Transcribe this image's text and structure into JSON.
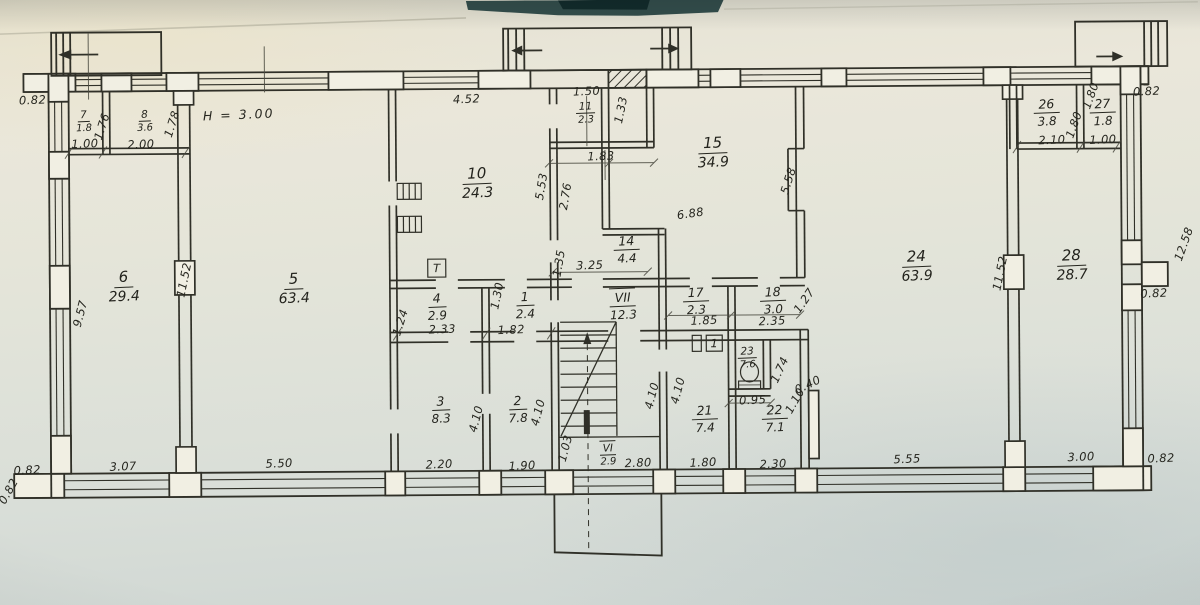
{
  "document": {
    "type": "scanned floor plan (BTI technical passport style)",
    "colors": {
      "paper": "#e6e4d7",
      "ink": "#2f2f28",
      "photo_edge": "#2a4644"
    }
  },
  "plan": {
    "height_note": "H = 3.00",
    "rooms": [
      {
        "no": "7",
        "area": "1.8",
        "x": 85,
        "y": 116,
        "s": "sm"
      },
      {
        "no": "8",
        "area": "3.6",
        "x": 146,
        "y": 116,
        "s": "sm"
      },
      {
        "no": "6",
        "area": "29.4",
        "x": 124,
        "y": 283,
        "s": "lg"
      },
      {
        "no": "5",
        "area": "63.4",
        "x": 294,
        "y": 286,
        "s": "lg"
      },
      {
        "no": "10",
        "area": "24.3",
        "x": 478,
        "y": 182,
        "s": "lg"
      },
      {
        "no": "11",
        "area": "2.3",
        "x": 587,
        "y": 111,
        "s": "sm"
      },
      {
        "no": "15",
        "area": "34.9",
        "x": 714,
        "y": 153,
        "s": "lg"
      },
      {
        "no": "14",
        "area": "4.4",
        "x": 627,
        "y": 249,
        "s": "md"
      },
      {
        "no": "VII",
        "area": "12.3",
        "x": 623,
        "y": 305,
        "s": "md",
        "rm": true
      },
      {
        "no": "17",
        "area": "2.3",
        "x": 696,
        "y": 301,
        "s": "md"
      },
      {
        "no": "18",
        "area": "3.0",
        "x": 773,
        "y": 301,
        "s": "md"
      },
      {
        "no": "4",
        "area": "2.9",
        "x": 437,
        "y": 305,
        "s": "md"
      },
      {
        "no": "1",
        "area": "2.4",
        "x": 525,
        "y": 304,
        "s": "md"
      },
      {
        "no": "3",
        "area": "8.3",
        "x": 440,
        "y": 408,
        "s": "md"
      },
      {
        "no": "2",
        "area": "7.8",
        "x": 517,
        "y": 408,
        "s": "md"
      },
      {
        "no": "VI",
        "area": "2.9",
        "x": 607,
        "y": 453,
        "s": "sm",
        "rm": true
      },
      {
        "no": "21",
        "area": "7.4",
        "x": 704,
        "y": 419,
        "s": "md"
      },
      {
        "no": "22",
        "area": "7.1",
        "x": 774,
        "y": 419,
        "s": "md"
      },
      {
        "no": "23",
        "area": "7.6",
        "x": 747,
        "y": 357,
        "s": "sm"
      },
      {
        "no": "24",
        "area": "63.9",
        "x": 917,
        "y": 268,
        "s": "lg"
      },
      {
        "no": "28",
        "area": "28.7",
        "x": 1072,
        "y": 268,
        "s": "lg"
      },
      {
        "no": "26",
        "area": "3.8",
        "x": 1048,
        "y": 115,
        "s": "md"
      },
      {
        "no": "27",
        "area": "1.8",
        "x": 1104,
        "y": 115,
        "s": "md"
      }
    ],
    "dims": [
      {
        "t": "0.82",
        "x": 34,
        "y": 96
      },
      {
        "t": "1.00",
        "x": 86,
        "y": 140
      },
      {
        "t": "2.00",
        "x": 142,
        "y": 141
      },
      {
        "t": "1.76",
        "x": 103,
        "y": 123,
        "r": -72
      },
      {
        "t": "1.78",
        "x": 173,
        "y": 121,
        "r": -72
      },
      {
        "t": "H = 3.00",
        "x": 240,
        "y": 112,
        "c": "note"
      },
      {
        "t": "4.52",
        "x": 468,
        "y": 98
      },
      {
        "t": "1.50",
        "x": 588,
        "y": 91
      },
      {
        "t": "1.33",
        "x": 622,
        "y": 110,
        "r": -78
      },
      {
        "t": "1.83",
        "x": 602,
        "y": 156
      },
      {
        "t": "5.53",
        "x": 542,
        "y": 186,
        "r": -80
      },
      {
        "t": "2.76",
        "x": 566,
        "y": 196,
        "r": -80
      },
      {
        "t": "6.88",
        "x": 691,
        "y": 214,
        "r": -8
      },
      {
        "t": "5.58",
        "x": 789,
        "y": 182,
        "r": -72
      },
      {
        "t": "0.82",
        "x": 1148,
        "y": 95
      },
      {
        "t": "1.80",
        "x": 1092,
        "y": 99,
        "r": -70
      },
      {
        "t": "1.80",
        "x": 1075,
        "y": 128,
        "r": -70
      },
      {
        "t": "2.10",
        "x": 1053,
        "y": 143
      },
      {
        "t": "1.00",
        "x": 1104,
        "y": 143
      },
      {
        "t": "12.58",
        "x": 1184,
        "y": 248,
        "r": -70
      },
      {
        "t": "0.82",
        "x": 1154,
        "y": 297
      },
      {
        "t": "9.57",
        "x": 80,
        "y": 310,
        "r": -75
      },
      {
        "t": "11.52",
        "x": 184,
        "y": 277,
        "r": -78
      },
      {
        "t": "11.52",
        "x": 1000,
        "y": 276,
        "r": -78
      },
      {
        "t": "1.24",
        "x": 400,
        "y": 321,
        "r": -72
      },
      {
        "t": "2.33",
        "x": 442,
        "y": 328
      },
      {
        "t": "1.30",
        "x": 497,
        "y": 295,
        "r": -78
      },
      {
        "t": "1.82",
        "x": 511,
        "y": 329
      },
      {
        "t": "3.25",
        "x": 590,
        "y": 265
      },
      {
        "t": "1.35",
        "x": 559,
        "y": 263,
        "r": -80
      },
      {
        "t": "1.85",
        "x": 704,
        "y": 321
      },
      {
        "t": "2.35",
        "x": 772,
        "y": 322
      },
      {
        "t": "1.27",
        "x": 804,
        "y": 302,
        "r": -55
      },
      {
        "t": "4.10",
        "x": 475,
        "y": 418,
        "r": -75
      },
      {
        "t": "4.10",
        "x": 537,
        "y": 412,
        "r": -75
      },
      {
        "t": "4.10",
        "x": 651,
        "y": 396,
        "r": -75
      },
      {
        "t": "4.10",
        "x": 677,
        "y": 391,
        "r": -75
      },
      {
        "t": "1.03",
        "x": 564,
        "y": 448,
        "r": -75
      },
      {
        "t": "0.95",
        "x": 752,
        "y": 401
      },
      {
        "t": "1.74",
        "x": 779,
        "y": 371,
        "r": -65
      },
      {
        "t": "0.40",
        "x": 807,
        "y": 386,
        "r": -25
      },
      {
        "t": "1.10",
        "x": 794,
        "y": 402,
        "r": -60
      },
      {
        "t": "0.82",
        "x": 26,
        "y": 466
      },
      {
        "t": "3.07",
        "x": 122,
        "y": 463
      },
      {
        "t": "5.50",
        "x": 278,
        "y": 461
      },
      {
        "t": "2.20",
        "x": 438,
        "y": 463
      },
      {
        "t": "1.90",
        "x": 521,
        "y": 465
      },
      {
        "t": "2.80",
        "x": 637,
        "y": 463
      },
      {
        "t": "1.80",
        "x": 702,
        "y": 463
      },
      {
        "t": "2.30",
        "x": 772,
        "y": 465
      },
      {
        "t": "5.55",
        "x": 906,
        "y": 461
      },
      {
        "t": "3.00",
        "x": 1080,
        "y": 460
      },
      {
        "t": "0.82",
        "x": 1160,
        "y": 462
      },
      {
        "t": "0.82",
        "x": 7,
        "y": 487,
        "r": -60
      }
    ],
    "fixture_labels": [
      {
        "t": "T",
        "x": 437,
        "y": 267
      },
      {
        "t": "1",
        "x": 714,
        "y": 344
      }
    ]
  }
}
